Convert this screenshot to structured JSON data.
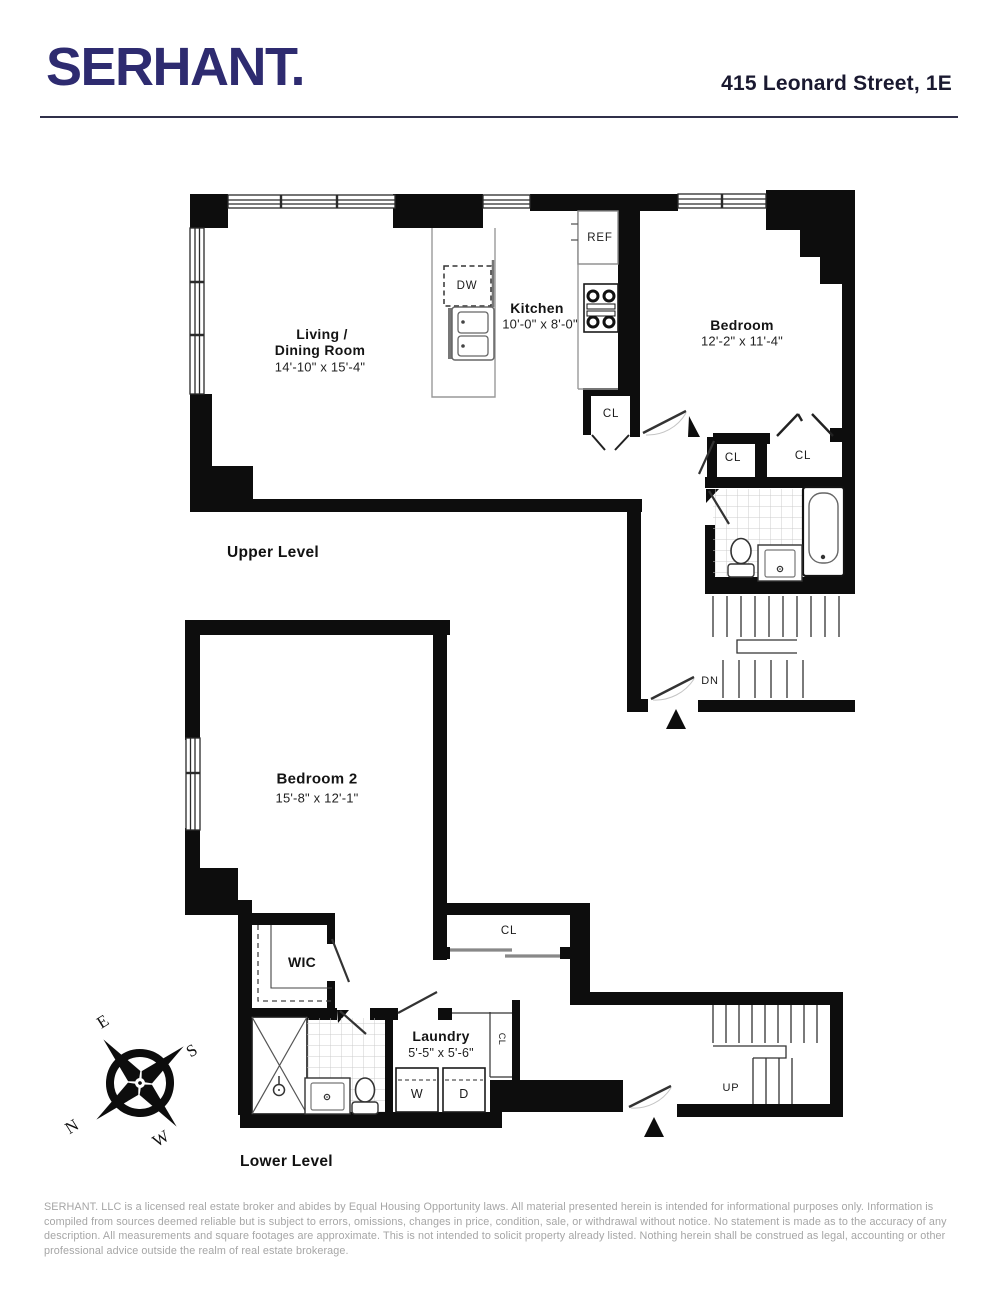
{
  "header": {
    "brand": "SERHANT.",
    "address": "415 Leonard Street, 1E"
  },
  "upper_level": {
    "title": "Upper Level",
    "living_dining": {
      "name_line1": "Living /",
      "name_line2": "Dining Room",
      "dims": "14'-10\" x 15'-4\""
    },
    "kitchen": {
      "name": "Kitchen",
      "dims": "10'-0\" x 8'-0\"",
      "dishwasher": "DW",
      "refrigerator": "REF",
      "closet": "CL"
    },
    "bedroom": {
      "name": "Bedroom",
      "dims": "12'-2\" x 11'-4\"",
      "closet_left": "CL",
      "closet_right": "CL"
    },
    "stairs": {
      "down": "DN"
    }
  },
  "lower_level": {
    "title": "Lower Level",
    "bedroom2": {
      "name": "Bedroom 2",
      "dims": "15'-8\" x 12'-1\""
    },
    "walk_in_closet": "WIC",
    "hall_closet": "CL",
    "narrow_closet": "CL",
    "laundry": {
      "name": "Laundry",
      "dims": "5'-5\" x 5'-6\"",
      "washer": "W",
      "dryer": "D"
    },
    "stairs": {
      "up": "UP"
    }
  },
  "compass": {
    "east": "E",
    "south": "S",
    "north": "N",
    "west": "W"
  },
  "footer": {
    "disclaimer": "SERHANT. LLC is a licensed real estate broker and abides by Equal Housing Opportunity laws. All material presented herein is intended for informational purposes only. Information is compiled from sources deemed reliable but is subject to errors, omissions, changes in price, condition, sale, or withdrawal without notice. No statement is made as to the accuracy of any description. All measurements and square footages are approximate. This is not intended to solicit property already listed. Nothing herein shall be construed as legal, accounting or other professional advice outside the realm of real estate brokerage."
  },
  "colors": {
    "brand_navy": "#2e2b70",
    "wall_black": "#0d0d0d",
    "line_gray": "#999999",
    "footer_gray": "#a6a6a6"
  }
}
